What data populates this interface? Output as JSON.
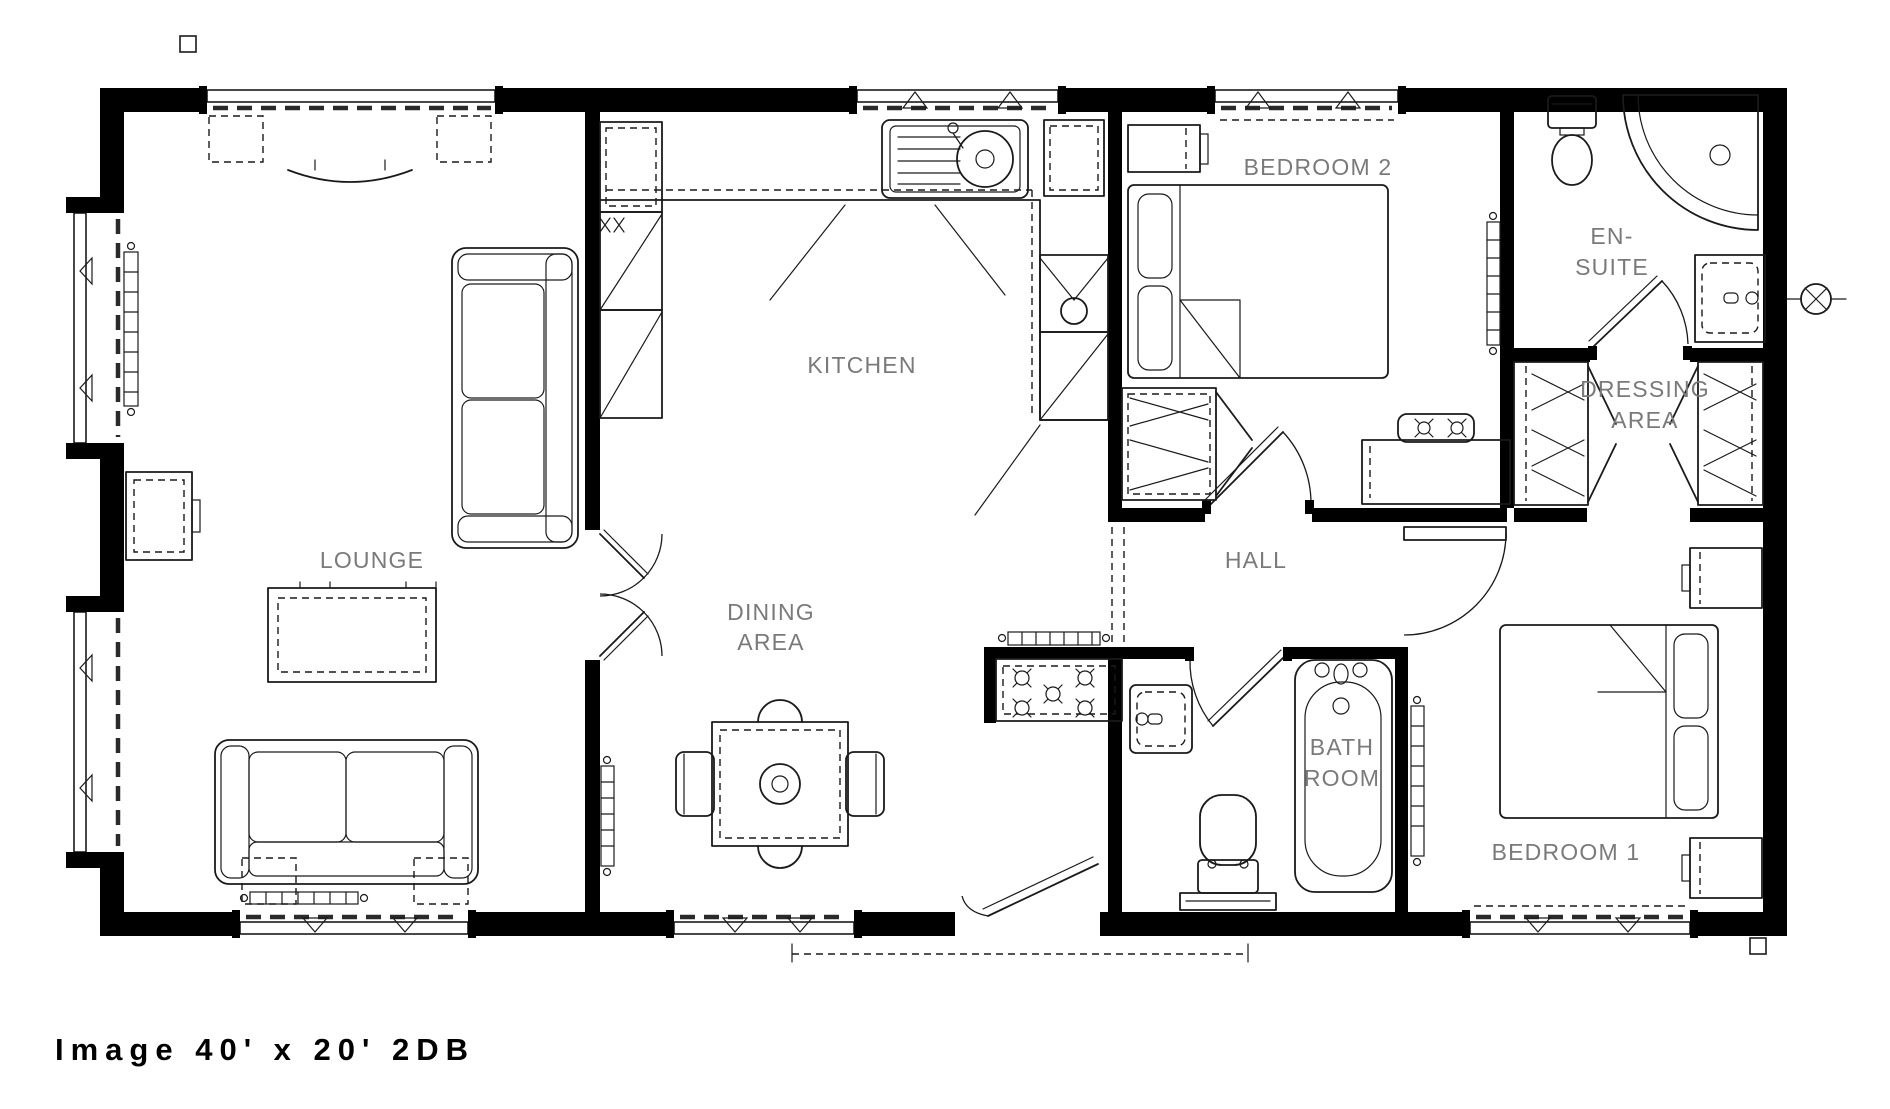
{
  "title": "Image 40' x 20' 2DB",
  "rooms": {
    "lounge": "LOUNGE",
    "kitchen": "KITCHEN",
    "dining_line1": "DINING",
    "dining_line2": "AREA",
    "hall": "HALL",
    "bathroom_line1": "BATH",
    "bathroom_line2": "ROOM",
    "bedroom1": "BEDROOM 1",
    "bedroom2": "BEDROOM 2",
    "ensuite_line1": "EN-",
    "ensuite_line2": "SUITE",
    "dressing_line1": "DRESSING",
    "dressing_line2": "AREA"
  },
  "fixtures": {
    "lounge": [
      "sofa",
      "sofa",
      "coffee-table",
      "side-table",
      "tv-unit",
      "radiator",
      "windows"
    ],
    "kitchen": [
      "sink-drainer",
      "worktop",
      "tall-units",
      "oven",
      "glazed-door",
      "radiator"
    ],
    "dining": [
      "table",
      "chairs",
      "radiator",
      "window"
    ],
    "hall": [
      "airing-cupboard"
    ],
    "bedroom2": [
      "double-bed",
      "bedside-table",
      "wardrobe",
      "dressing-table",
      "stool",
      "radiator",
      "window"
    ],
    "ensuite": [
      "toilet",
      "quadrant-shower",
      "basin",
      "wall-light"
    ],
    "dressing_area": [
      "wardrobe",
      "wardrobe"
    ],
    "bathroom": [
      "bath",
      "toilet",
      "basin"
    ],
    "bedroom1": [
      "double-bed",
      "bedside-table",
      "bedside-table",
      "radiator",
      "window"
    ]
  },
  "colors": {
    "walls": "#000000",
    "furniture_lines": "#1a1a1a",
    "room_labels": "#7a7a7a",
    "background": "#ffffff"
  }
}
